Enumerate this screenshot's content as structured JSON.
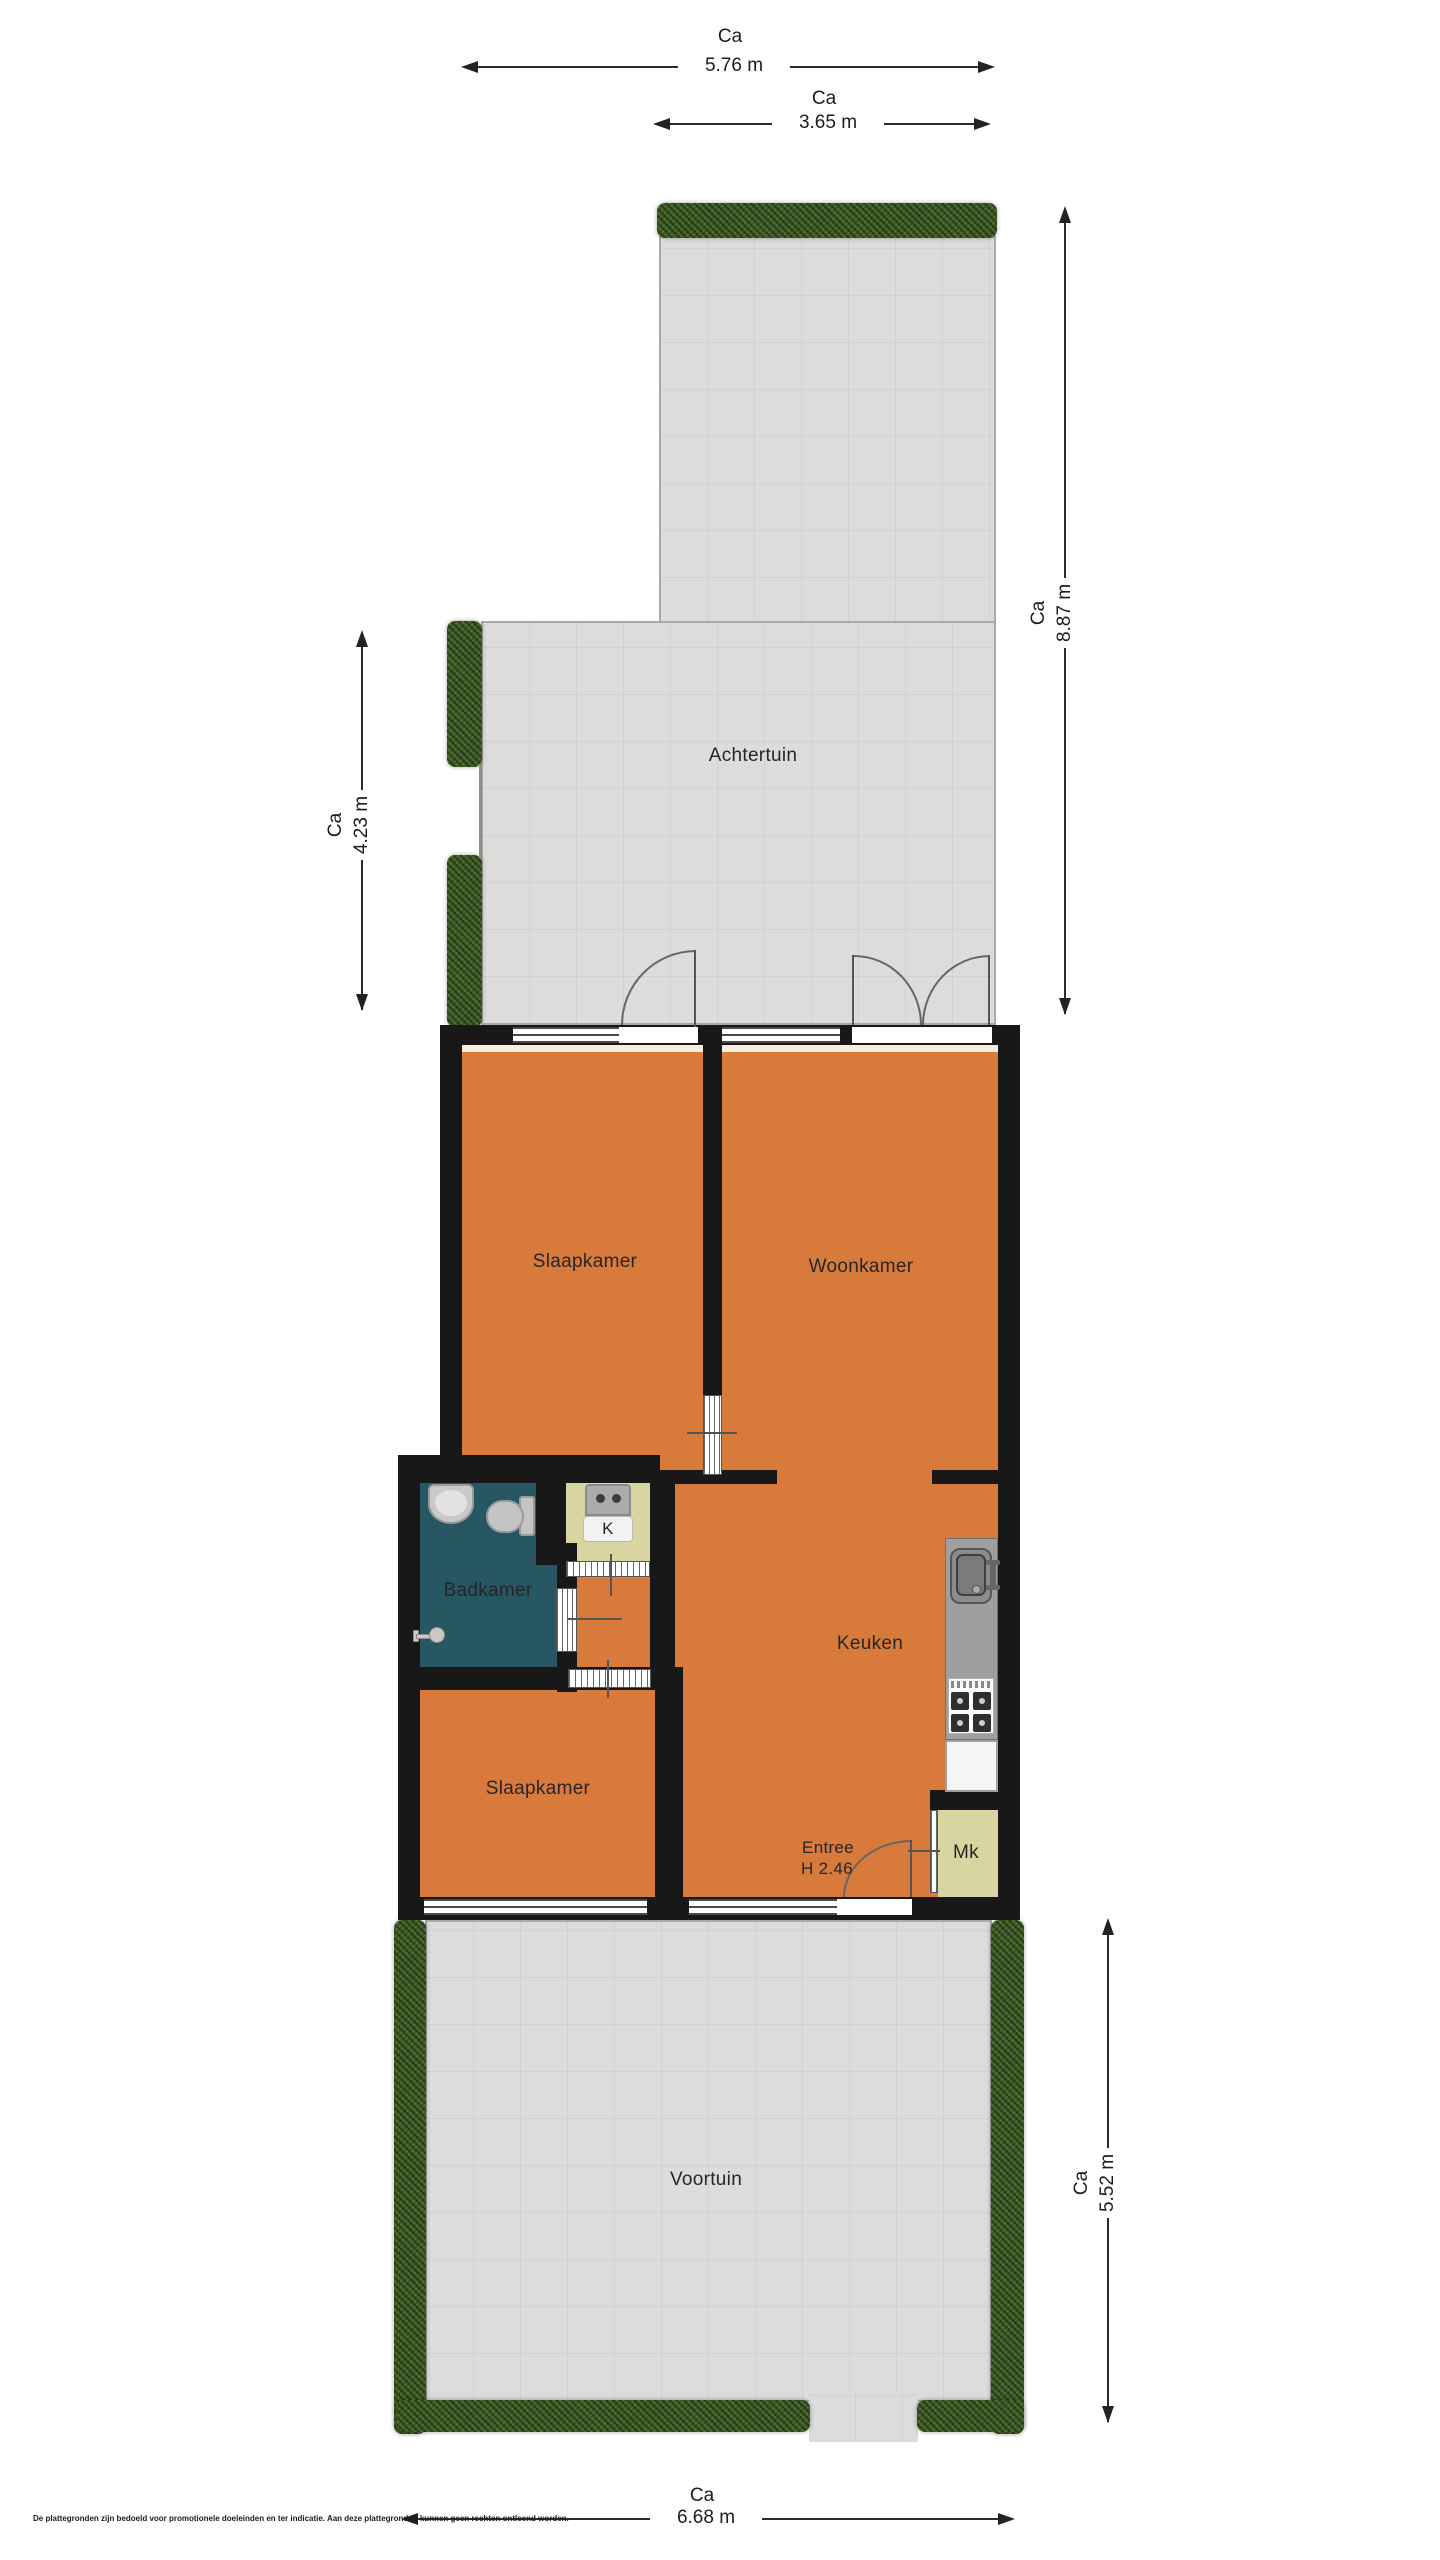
{
  "labels": {
    "achtertuin": "Achtertuin",
    "slaapkamer_boven": "Slaapkamer",
    "woonkamer": "Woonkamer",
    "badkamer": "Badkamer",
    "kast": "K",
    "keuken": "Keuken",
    "entree_line1": "Entree",
    "entree_line2": "H 2.46",
    "meterkast": "Mk",
    "slaapkamer_onder": "Slaapkamer",
    "voortuin": "Voortuin"
  },
  "dims": {
    "top_outer": {
      "ca": "Ca",
      "value": "5.76 m"
    },
    "top_inner": {
      "ca": "Ca",
      "value": "3.65 m"
    },
    "right_achtertuin": {
      "ca": "Ca",
      "value": "8.87 m"
    },
    "left_achtertuin": {
      "ca": "Ca",
      "value": "4.23 m"
    },
    "right_voortuin": {
      "ca": "Ca",
      "value": "5.52 m"
    },
    "bottom_voortuin": {
      "ca": "Ca",
      "value": "6.68 m"
    }
  },
  "disclaimer": "De plattegronden zijn bedoeld voor promotionele doeleinden en ter indicatie. Aan deze plattegronden kunnen geen rechten ontleend worden.",
  "icons": [
    "hedge",
    "door-swing-arc",
    "window",
    "toilet-icon",
    "washbasin-icon",
    "shower-icon",
    "washing-machine-icon",
    "kitchen-sink-icon",
    "faucet-icon",
    "stove-icon"
  ],
  "colors": {
    "room_orange": "#d87a3c",
    "bathroom_teal": "#265762",
    "closet_yellow": "#d9d5a0",
    "wall_black": "#181818",
    "garden_gray": "#dcdcdb",
    "hedge_green": "#3e5c28"
  }
}
